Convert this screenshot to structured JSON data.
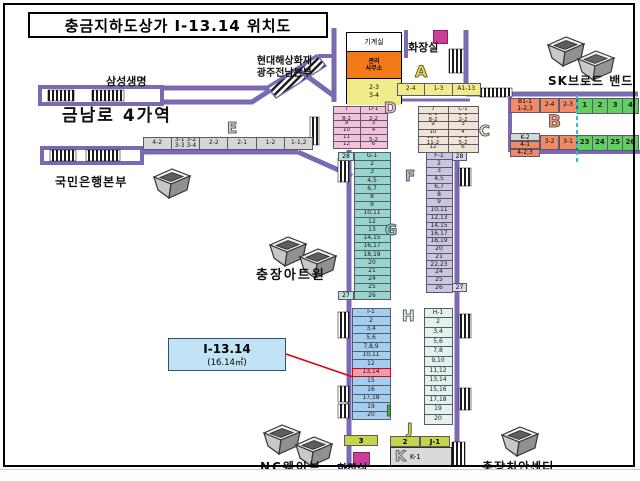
{
  "title": "충금지하도상가 I-13.14 위치도",
  "labels": {
    "samsung": "삼성생명",
    "hyundai": "현대해상화재\n광주전남본부",
    "machine_room": "기계실",
    "toilet_top": "화장실",
    "office": "관리\n사무소",
    "sk": "SK브로드 밴드",
    "station": "금남로 4가역",
    "kb": "국민은행본부",
    "artone": "충장아트원",
    "ncwave": "NC웨이브",
    "toilet_bottom": "화장실",
    "police": "충장치안센터"
  },
  "callout": {
    "unit": "I-13.14",
    "area": "(16.14㎡)"
  },
  "letters": {
    "a": "A",
    "b": "B",
    "c": "C",
    "d": "D",
    "e": "E",
    "f": "F",
    "g": "G",
    "h": "H",
    "i": "I",
    "j": "J",
    "k": "K"
  },
  "machine": {
    "office_yellow": "2-3\n3-4"
  },
  "a_cells": [
    "2-4",
    "1-3",
    "A1-13"
  ],
  "b": {
    "head": "B1-1\n1-2,3",
    "c1": "2-4",
    "c2": "2-3",
    "green_top": [
      "1",
      "2",
      "3",
      "4"
    ],
    "k2": "K-2",
    "r1": "4-1",
    "r2": "4-2,3",
    "c3": "3-2",
    "c4": "3-1",
    "green_bottom": [
      "23",
      "24",
      "25",
      "26"
    ]
  },
  "e_cells": [
    "4-2",
    "3-1 3-2\n3-3 3-4",
    "2-2",
    "2-1",
    "1-2",
    "1-1,2"
  ],
  "d": {
    "left": [
      "7",
      "8-1\n8-2",
      "9",
      "10",
      "11",
      "12"
    ],
    "right": [
      "D-1",
      "2-1\n2-2",
      "3",
      "4",
      "5-1\n5-2",
      "6"
    ]
  },
  "c": {
    "left": [
      "7",
      "8-1\n8-2",
      "9",
      "10",
      "11-1\n11-2",
      "12"
    ],
    "right": [
      "C-1",
      "2-1\n2-2",
      "3",
      "4",
      "5-1\n5-2",
      "6"
    ]
  },
  "g_cells": [
    "G-1",
    "2",
    "3",
    "4,5",
    "6,7",
    "8",
    "9",
    "10,11",
    "12",
    "13",
    "14,15",
    "16,17",
    "18,19",
    "20",
    "21",
    "24",
    "25",
    "26"
  ],
  "g_first": "28",
  "g_last": "27",
  "f_cells": [
    "F-1",
    "2",
    "3",
    "4,5",
    "6,7",
    "8",
    "9",
    "10,11",
    "12,13",
    "14,15",
    "16,17",
    "18,19",
    "20",
    "21",
    "22,23",
    "24",
    "25",
    "26"
  ],
  "f_first": "28",
  "f_last": "27",
  "i_cells": [
    "I-1",
    "2",
    "3,4",
    "5,6",
    "7,8,9",
    "10,11",
    "12",
    "13,14",
    "15",
    "16",
    "17,18",
    "19",
    "20"
  ],
  "i_highlight_index": 7,
  "h_cells": [
    "H-1",
    "2",
    "3,4",
    "5,6",
    "7,8",
    "9,10",
    "11,12",
    "13,14",
    "15,16",
    "17,18",
    "19",
    "20"
  ],
  "bottom": {
    "bar3": "3",
    "j_c1": "2",
    "j_c2": "J-1",
    "k_label": "K-1"
  },
  "colors": {
    "wall": "#7b6ab2",
    "highlight": "#eb9fab",
    "highlight_border": "#e00013",
    "teal_dash": "#2cc4c4",
    "green": "#63ce63",
    "salmon": "#f08a68",
    "g_col": "#97d5ce",
    "f_col": "#c9c6e2",
    "i_col": "#a3cef0",
    "h_col": "#e4f2ee"
  }
}
